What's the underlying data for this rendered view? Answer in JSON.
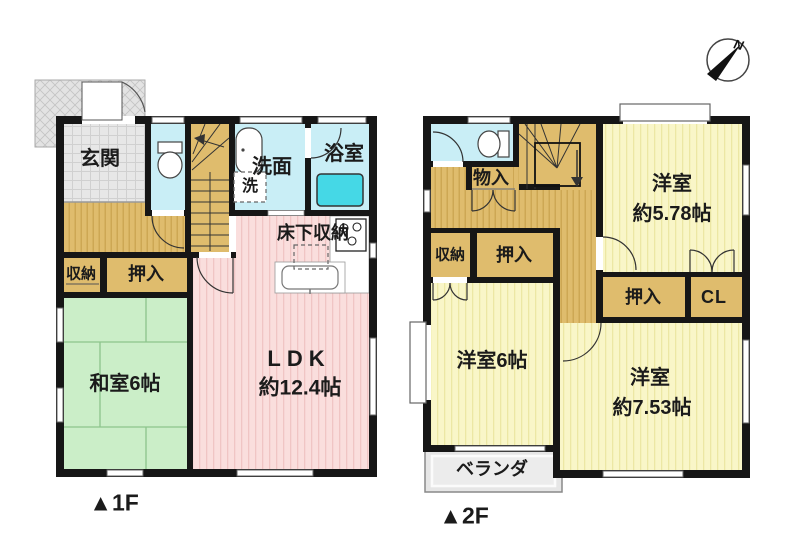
{
  "compass": {
    "north_label": "N"
  },
  "floor1": {
    "tag": "▲1F",
    "genkan": "玄関",
    "senmen": "洗面",
    "sen": "洗",
    "yokushitsu": "浴室",
    "yukashita": "床下収納",
    "shuunou": "収納",
    "oshiire": "押入",
    "washitsu": "和室6帖",
    "ldk_line1": "LDK",
    "ldk_line2": "約12.4帖"
  },
  "floor2": {
    "tag": "▲2F",
    "monoiri": "物入",
    "shuunou": "収納",
    "oshiire_a": "押入",
    "west578_line1": "洋室",
    "west578_line2": "約5.78帖",
    "oshiire_b": "押入",
    "cl": "CL",
    "west6": "洋室6帖",
    "west753_line1": "洋室",
    "west753_line2": "約7.53帖",
    "veranda": "ベランダ"
  },
  "colors": {
    "wall": "#161616",
    "tan_floor": "#dfbc6d",
    "cyan_room": "#c9eef6",
    "bathtub": "#45d8e6",
    "pink_ldk": "#fadedd",
    "green_tatami": "#cbeec8",
    "yellow_room": "#f9f6c8",
    "entrance_gray": "#e7e7e7",
    "porch_gray": "#e3e3e3",
    "veranda_gray": "#e6e6e6"
  }
}
